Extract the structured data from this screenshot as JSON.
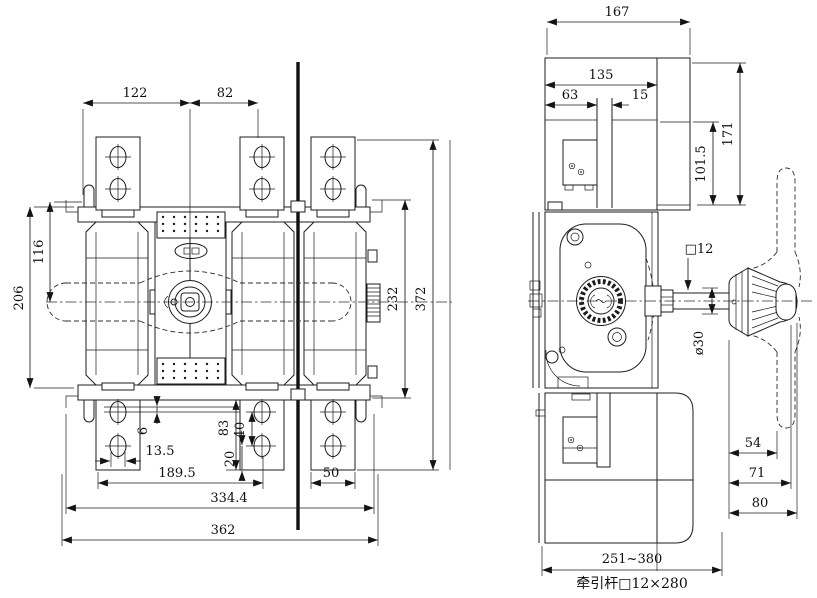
{
  "colors": {
    "line": "#1c1c1c",
    "background": "#ffffff"
  },
  "front_view": {
    "dim_width_left": "122",
    "dim_width_right": "82",
    "dim_height_center": "116",
    "dim_height_body": "206",
    "dim_height_inner": "232",
    "dim_height_overall": "372",
    "dim_hole_offset": "6",
    "dim_slot_width": "13.5",
    "dim_tab_height": "83",
    "dim_hole_pitch": "40",
    "dim_hole_edge": "20",
    "dim_hole_span": "189.5",
    "dim_tab_width": "50",
    "dim_width_mounting": "334.4",
    "dim_width_overall": "362"
  },
  "side_view": {
    "dim_depth_overall": "167",
    "dim_depth_body": "135",
    "dim_shaft_offset": "63",
    "dim_shaft_width": "15",
    "dim_height_right": "171",
    "dim_height_step": "101.5",
    "label_shaft_square": "□12",
    "label_handle_dia": "ø30",
    "dim_handle_54": "54",
    "dim_handle_71": "71",
    "dim_handle_80": "80",
    "dim_depth_range": "251~380",
    "note_traction_rod": "牵引杆□12×280"
  }
}
